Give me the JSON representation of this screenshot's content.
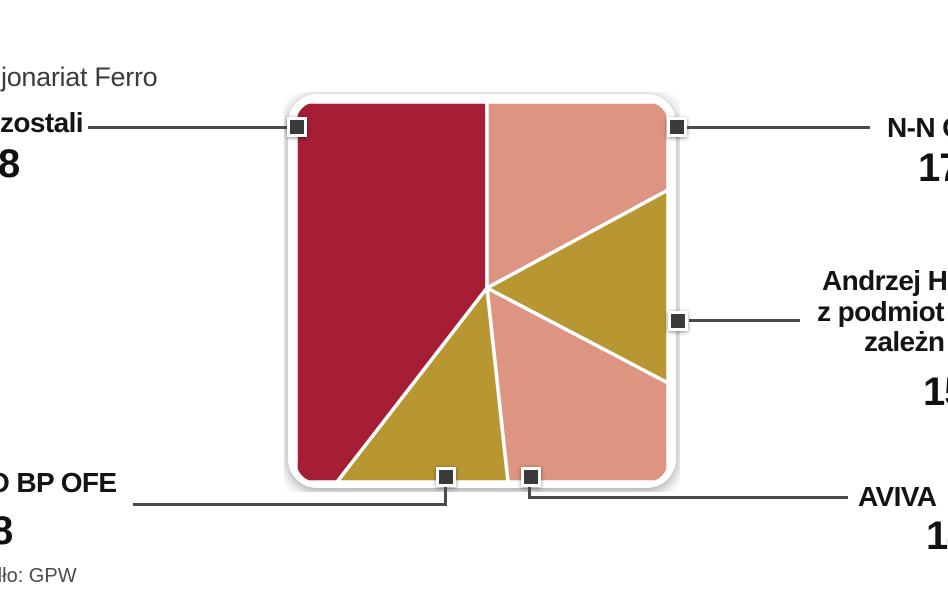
{
  "title": "jonariat Ferro",
  "source": "dło: GPW",
  "callouts": {
    "pozostali": {
      "label": "zostali",
      "value": "8"
    },
    "nn": {
      "label": "N-N O",
      "value": "17"
    },
    "andrzej": {
      "line1": "Andrzej H",
      "line2": "z podmiot",
      "line3": "zależn",
      "value": "15"
    },
    "pko": {
      "label": "O BP OFE",
      "value": "8"
    },
    "aviva": {
      "label": "AVIVA",
      "value": "14"
    }
  },
  "colors": {
    "red": "#a51e35",
    "salmon": "#dd9480",
    "gold": "#b89733",
    "marker": "#3a3a3a",
    "line": "#4a4a4a",
    "frame": "#ffffff"
  },
  "chart_data": {
    "type": "pie",
    "shape": "rounded-square",
    "note": "square pie chart, slices clockwise from 12 o'clock; labels clipped at image edges; percents estimated from slice angles",
    "slices": [
      {
        "label": "zostali",
        "value_visible": "8",
        "percent_est": 39.6,
        "color": "#a51e35",
        "callout_side": "top-left"
      },
      {
        "label": "N-N O",
        "value_visible": "17",
        "percent_est": 17.4,
        "color": "#dd9480",
        "callout_side": "top-right"
      },
      {
        "label": "Andrzej H z podmiot zależn",
        "value_visible": "15",
        "percent_est": 15.6,
        "color": "#b89733",
        "callout_side": "right"
      },
      {
        "label": "AVIVA",
        "value_visible": "14",
        "percent_est": 15.1,
        "color": "#dd9480",
        "callout_side": "bottom-right"
      },
      {
        "label": "O BP OFE",
        "value_visible": "8",
        "percent_est": 12.4,
        "color": "#b89733",
        "callout_side": "bottom-left"
      }
    ],
    "title": "jonariat Ferro",
    "source": "dło: GPW",
    "legend": "none"
  }
}
